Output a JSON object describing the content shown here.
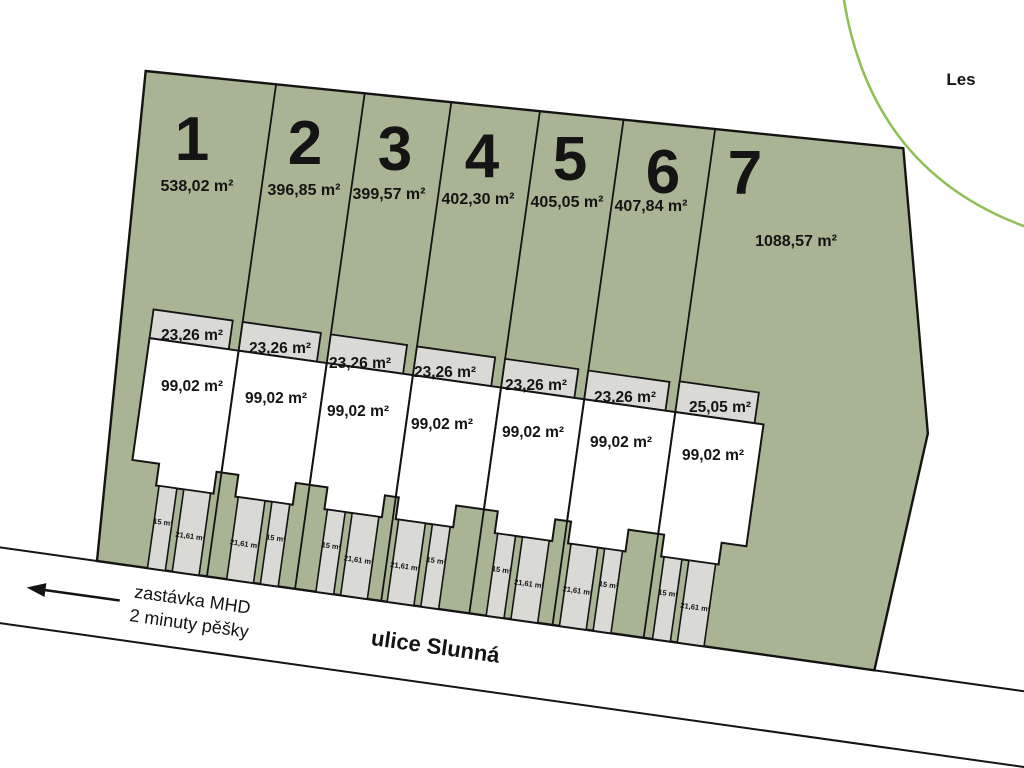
{
  "scene": {
    "forest_label": "Les",
    "street_label": "ulice Slunná",
    "transit_label_line1": "zastávka MHD",
    "transit_label_line2": "2 minuty pěšky"
  },
  "plots": [
    {
      "number": "1",
      "area": "538,02 m²",
      "terrace": "23,26 m²",
      "house": "99,02 m²",
      "drive_a": "15 m²",
      "drive_b": "21,61 m²"
    },
    {
      "number": "2",
      "area": "396,85 m²",
      "terrace": "23,26 m²",
      "house": "99,02 m²",
      "drive_a": "21,61 m²",
      "drive_b": "15 m²"
    },
    {
      "number": "3",
      "area": "399,57 m²",
      "terrace": "23,26 m²",
      "house": "99,02 m²",
      "drive_a": "15 m²",
      "drive_b": "21,61 m²"
    },
    {
      "number": "4",
      "area": "402,30 m²",
      "terrace": "23,26 m²",
      "house": "99,02 m²",
      "drive_a": "21,61 m²",
      "drive_b": "15 m²"
    },
    {
      "number": "5",
      "area": "405,05 m²",
      "terrace": "23,26 m²",
      "house": "99,02 m²",
      "drive_a": "15 m²",
      "drive_b": "21,61 m²"
    },
    {
      "number": "6",
      "area": "407,84 m²",
      "terrace": "23,26 m²",
      "house": "99,02 m²",
      "drive_a": "21,61 m²",
      "drive_b": "15 m²"
    },
    {
      "number": "7",
      "area": "1088,57 m²",
      "terrace": "25,05 m²",
      "house": "99,02 m²",
      "drive_a": "15 m²",
      "drive_b": "21,61 m²"
    }
  ],
  "colors": {
    "parcel_green": "#a9b494",
    "strip_gray": "#d9d9d5",
    "forest_line_green": "#8fbf55",
    "line_black": "#141414"
  }
}
